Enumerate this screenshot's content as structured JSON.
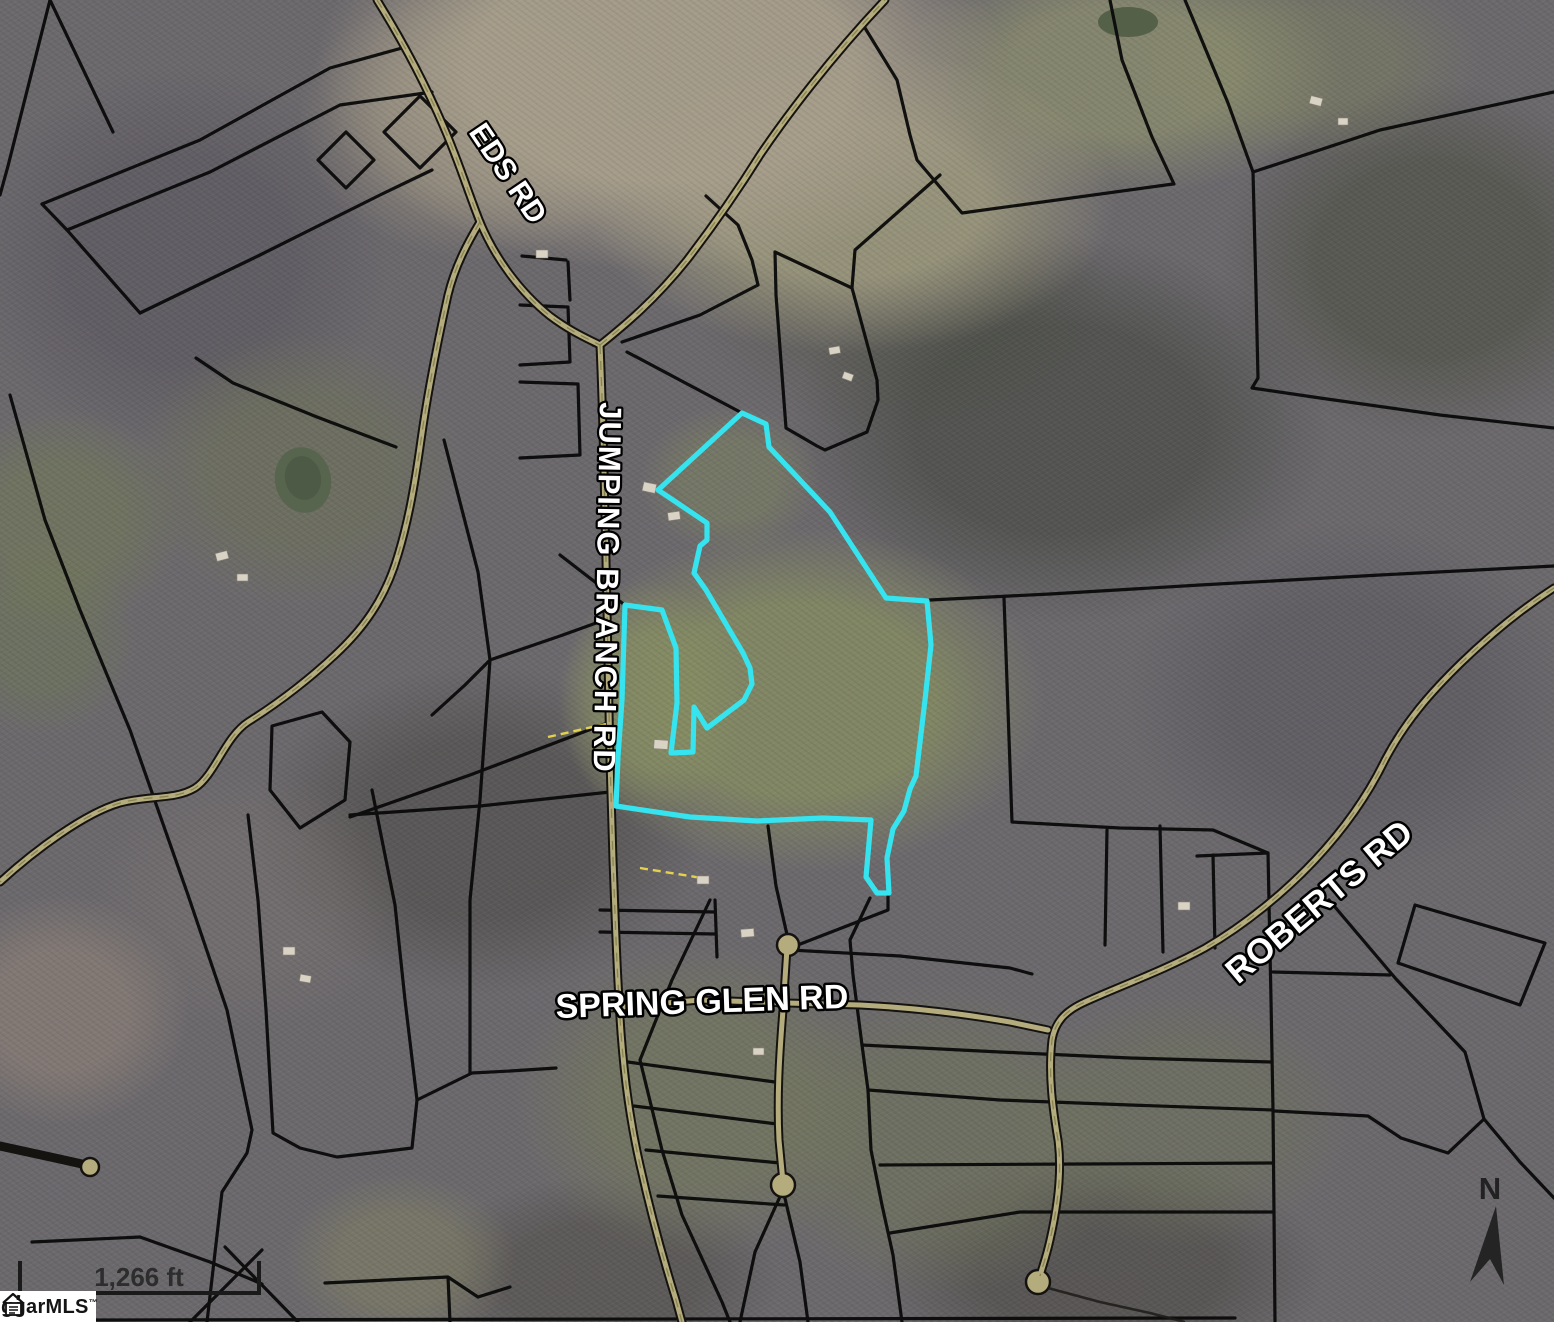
{
  "map": {
    "road_labels": [
      {
        "id": "eds-rd",
        "text": "EDS RD"
      },
      {
        "id": "jumping-branch-rd",
        "text": "JUMPING BRANCH RD"
      },
      {
        "id": "spring-glen-rd",
        "text": "SPRING GLEN RD"
      },
      {
        "id": "roberts-rd",
        "text": "ROBERTS RD"
      }
    ],
    "scale_bar": {
      "label": "1,266 ft"
    },
    "north_arrow": {
      "label": "N"
    },
    "logo": {
      "text": "ggarMLS",
      "trademark": "™"
    },
    "colors": {
      "highlight": "#35E4EF",
      "parcel_line": "#0a0a0a",
      "road_fill": "#b5ac7e"
    }
  }
}
